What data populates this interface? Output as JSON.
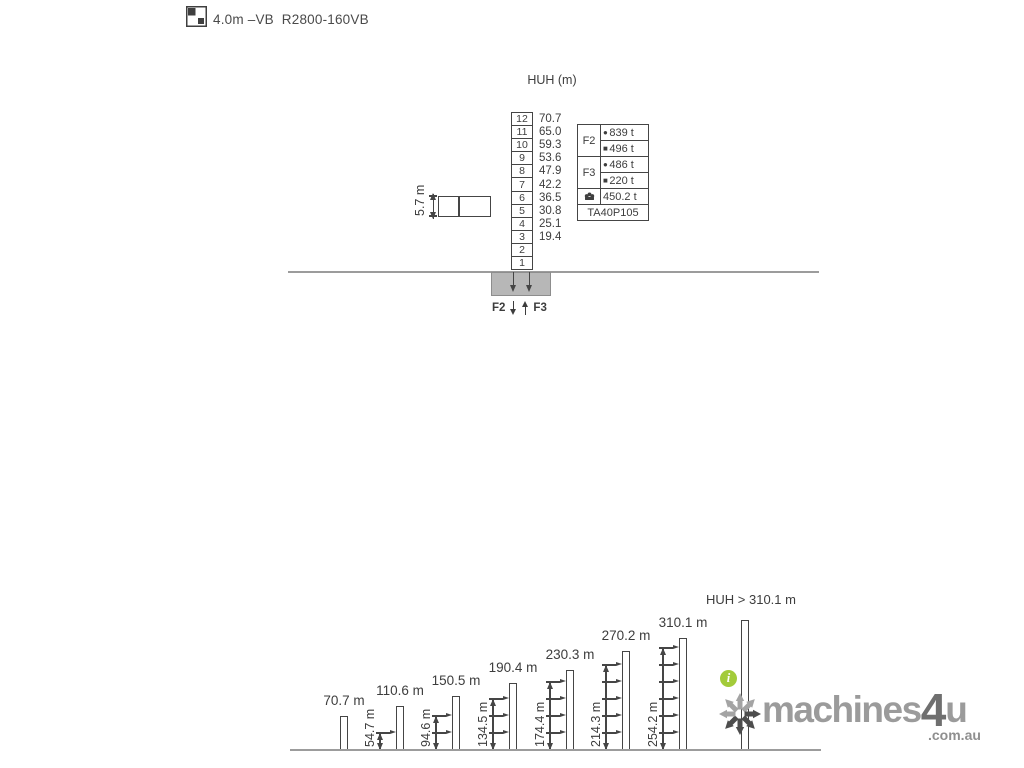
{
  "header": {
    "icon": "tower-cross-section-icon",
    "title": "4.0m –VB  R2800-160VB"
  },
  "tower_diagram": {
    "axis_label": "HUH (m)",
    "sections": [
      {
        "no": "12",
        "huh": "70.7"
      },
      {
        "no": "11",
        "huh": "65.0"
      },
      {
        "no": "10",
        "huh": "59.3"
      },
      {
        "no": "9",
        "huh": "53.6"
      },
      {
        "no": "8",
        "huh": "47.9"
      },
      {
        "no": "7",
        "huh": "42.2"
      },
      {
        "no": "6",
        "huh": "36.5"
      },
      {
        "no": "5",
        "huh": "30.8"
      },
      {
        "no": "4",
        "huh": "25.1"
      },
      {
        "no": "3",
        "huh": "19.4"
      },
      {
        "no": "2",
        "huh": ""
      },
      {
        "no": "1",
        "huh": ""
      }
    ],
    "section_length_label": "5.7 m",
    "corner_force_table": {
      "groups": [
        {
          "label": "F2",
          "entries": [
            {
              "marker": "●",
              "value": "839 t"
            },
            {
              "marker": "■",
              "value": "496 t"
            }
          ]
        },
        {
          "label": "F3",
          "entries": [
            {
              "marker": "●",
              "value": "486 t"
            },
            {
              "marker": "■",
              "value": "220 t"
            }
          ]
        }
      ],
      "ballast_row": {
        "icon": "ballast-icon",
        "value": "450.2 t"
      },
      "footer": "TA40P105"
    },
    "foundation_forces": {
      "down_label": "F2",
      "up_label": "F3"
    }
  },
  "climbing_diagram": {
    "title": "HUH > 310.1 m",
    "towers": [
      {
        "height_label": "70.7 m",
        "tie_height_label": "",
        "tie_count": 0
      },
      {
        "height_label": "110.6 m",
        "tie_height_label": "54.7 m",
        "tie_count": 1
      },
      {
        "height_label": "150.5 m",
        "tie_height_label": "94.6 m",
        "tie_count": 2
      },
      {
        "height_label": "190.4 m",
        "tie_height_label": "134.5 m",
        "tie_count": 3
      },
      {
        "height_label": "230.3 m",
        "tie_height_label": "174.4 m",
        "tie_count": 4
      },
      {
        "height_label": "270.2 m",
        "tie_height_label": "214.3 m",
        "tie_count": 5
      },
      {
        "height_label": "310.1 m",
        "tie_height_label": "254.2 m",
        "tie_count": 6
      },
      {
        "height_label": "",
        "tie_height_label": "",
        "tie_count": 0
      }
    ],
    "info_icon_glyph": "i"
  },
  "watermark": {
    "brand": "machines",
    "brand_number": "4",
    "brand_suffix": "u",
    "domain": ".com.au"
  },
  "colors": {
    "line": "#454545",
    "ground": "#9c9c9c",
    "foundation_fill": "#b7b7b7",
    "info_green": "#a3cb3a",
    "logo_gray": "#9b9b9b",
    "logo_dark": "#6f6f6f"
  }
}
